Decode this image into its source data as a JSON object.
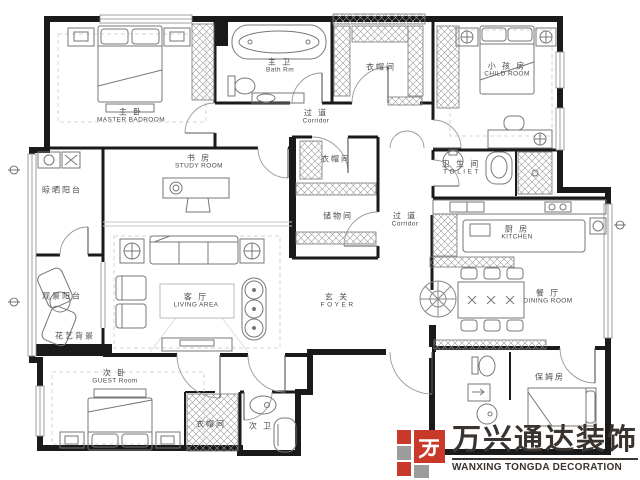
{
  "plan": {
    "rooms": {
      "master": {
        "zh": "主 卧",
        "en": "MASTER BADROOM"
      },
      "bath_main": {
        "zh": "主 卫",
        "en": "Bath Rm"
      },
      "cloak_top": {
        "zh": "衣帽间",
        "en": ""
      },
      "child": {
        "zh": "小 孩 房",
        "en": "CHILD ROOM"
      },
      "corridor_top": {
        "zh": "过 道",
        "en": "Corridor"
      },
      "study": {
        "zh": "书 房",
        "en": "STUDY ROOM"
      },
      "cloak_center": {
        "zh": "衣帽间",
        "en": ""
      },
      "storage": {
        "zh": "储物间",
        "en": ""
      },
      "corridor_right": {
        "zh": "过 道",
        "en": "Corridor"
      },
      "toilet": {
        "zh": "卫 生 间",
        "en": "T O L I E T"
      },
      "kitchen": {
        "zh": "厨 房",
        "en": "KITCHEN"
      },
      "dining": {
        "zh": "餐 厅",
        "en": "DINING ROOM"
      },
      "living": {
        "zh": "客 厅",
        "en": "LIVING AREA"
      },
      "foyer": {
        "zh": "玄 关",
        "en": "F O Y E R"
      },
      "balcony_laundry": {
        "zh": "晾晒阳台",
        "en": ""
      },
      "balcony_leisure": {
        "zh": "观景阳台",
        "en": ""
      },
      "flower_feature": {
        "zh": "花艺背景",
        "en": ""
      },
      "guest": {
        "zh": "次 卧",
        "en": "GUEST Room"
      },
      "cloak_guest": {
        "zh": "衣帽间",
        "en": ""
      },
      "bath_second": {
        "zh": "次 卫",
        "en": ""
      },
      "nanny": {
        "zh": "保姆房",
        "en": ""
      }
    },
    "colors": {
      "wall": "#1a1a1a",
      "furniture": "#777777",
      "label": "#4b4b4b"
    }
  },
  "logo": {
    "zh": "万兴通达装饰",
    "en": "WANXING TONGDA DECORATION",
    "red": "#c9392a",
    "gray": "#9c9c9c",
    "text_color": "#3a3430"
  }
}
